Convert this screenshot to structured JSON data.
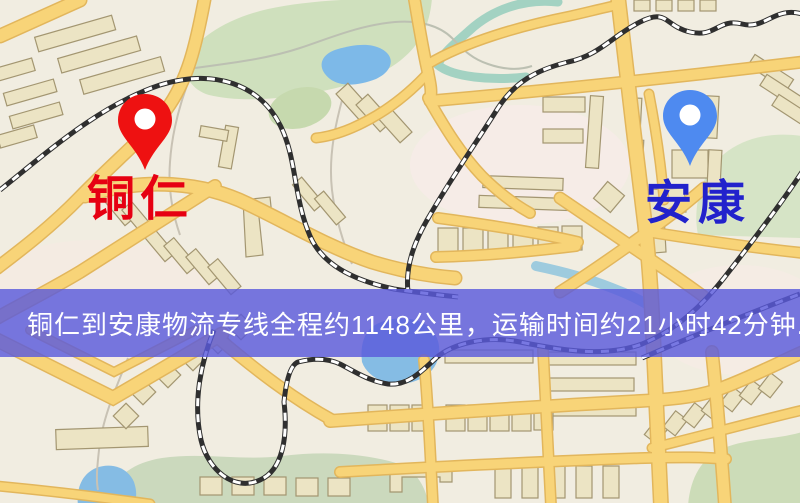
{
  "pins": {
    "origin": {
      "name": "铜仁",
      "pin_color": "#ee1111",
      "label_color": "#e60012"
    },
    "destination": {
      "name": "安康",
      "pin_color": "#4e8af0",
      "label_color": "#2222cc"
    }
  },
  "banner": {
    "text": "铜仁到安康物流专线全程约1148公里，运输时间约21小时42分钟.",
    "background_color": "#5a5adc",
    "text_color": "#ffffff"
  },
  "map_palette": {
    "background": "#f1ede1",
    "road_fill": "#f8d478",
    "road_casing": "#e2b65c",
    "park_green": "#cfe0bd",
    "water_blue": "#85bce4",
    "river_teal": "#a3d2c2",
    "building_fill": "#ece4c4",
    "building_outline": "#a39671",
    "railway_dark": "#2f2f2f"
  }
}
